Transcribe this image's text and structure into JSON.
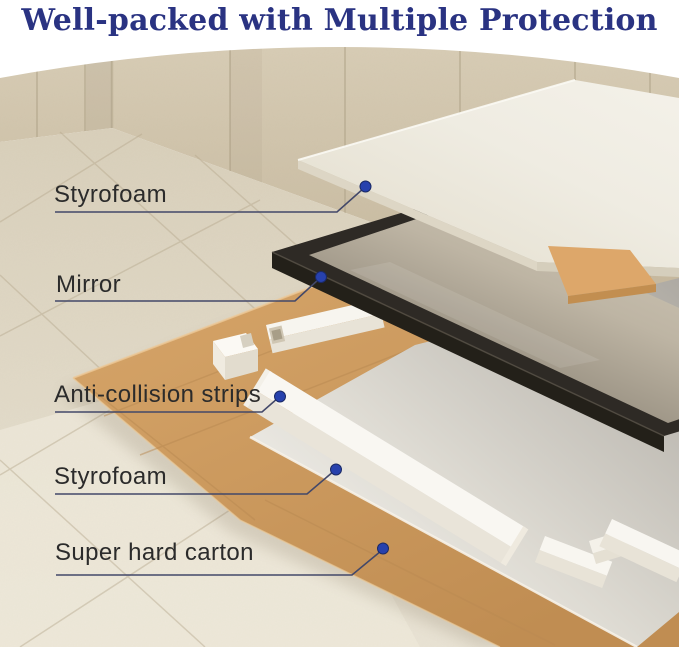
{
  "title": "Well-packed with Multiple Protection",
  "labels": [
    {
      "text": "Styrofoam"
    },
    {
      "text": "Mirror"
    },
    {
      "text": "Anti-collision strips"
    },
    {
      "text": "Styrofoam"
    },
    {
      "text": "Super hard carton"
    }
  ],
  "scene_items": [
    "top styrofoam sheet",
    "framed mirror",
    "anti-collision foam strips and corner blocks",
    "bottom styrofoam sheet",
    "cardboard corner protector",
    "super hard carton sheet"
  ],
  "colors": {
    "title_text": "#2a3382",
    "label_text": "#2b2b2b",
    "callout_line": "#434869",
    "callout_dot": "#2741ad",
    "styrofoam": "#f0ede4",
    "mirror_frame": "#2e2a25",
    "carton": "#cc9a60",
    "wall": "#ccc0a8",
    "floor": "#e4dcca",
    "background": "#ffffff"
  }
}
